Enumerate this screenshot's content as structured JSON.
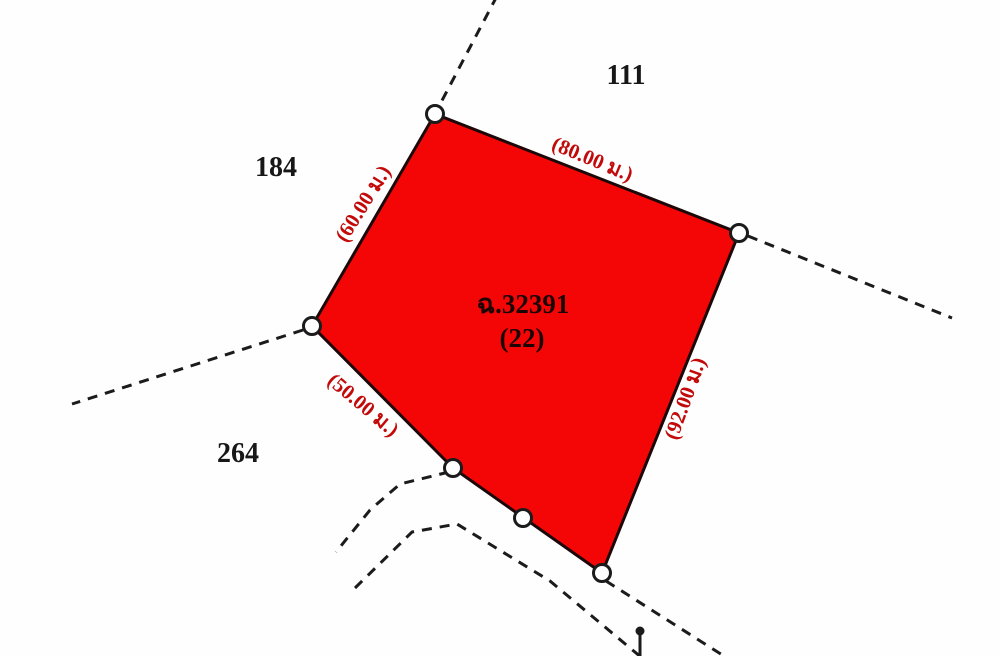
{
  "diagram": {
    "background_color": "#fefefe",
    "line_color": "#1b1b1b",
    "parcel": {
      "fill_color": "#f50606",
      "border_color": "#1c0808",
      "deed_number": "ฉ.32391",
      "plot_number": "(22)",
      "label_color": "#1c0404"
    },
    "dimension_label_color": "#c20a0a",
    "dimension_labels": {
      "top": "(80.00 ม.)",
      "upper_left": "(60.00 ม.)",
      "lower_left": "(50.00 ม.)",
      "right": "(92.00 ม.)"
    },
    "neighbor_plot_color": "#171717",
    "neighbor_plots": {
      "north": "111",
      "west": "184",
      "southwest": "264"
    }
  }
}
